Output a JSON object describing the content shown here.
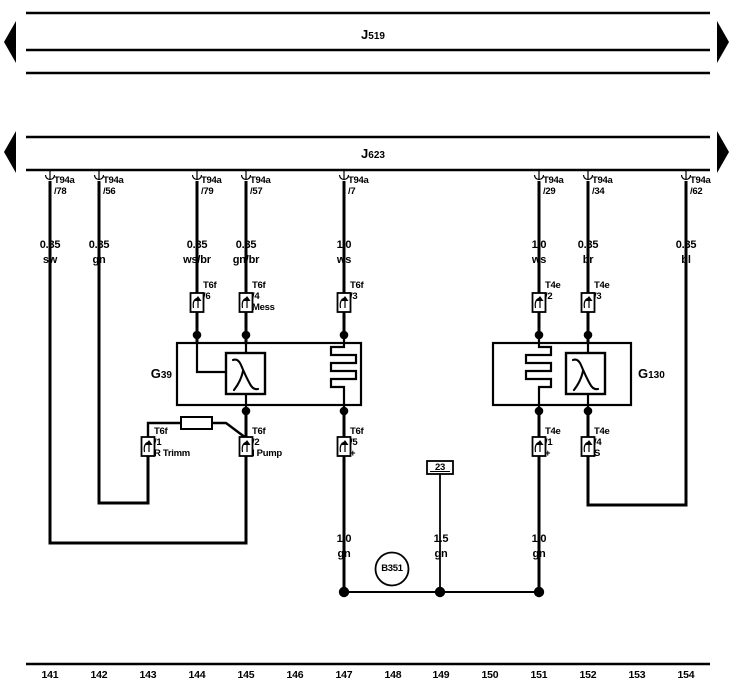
{
  "diagram_type": "wiring-diagram",
  "colors": {
    "line": "#000000",
    "background": "#ffffff"
  },
  "buses": {
    "j519": {
      "prefix": "J",
      "num": "519"
    },
    "j623": {
      "prefix": "J",
      "num": "623"
    }
  },
  "components": {
    "g39": {
      "prefix": "G",
      "num": "39"
    },
    "g130": {
      "prefix": "G",
      "num": "130"
    },
    "b351": {
      "label": "B351"
    },
    "ground_point": {
      "label": "23"
    }
  },
  "top_connectors": [
    {
      "name": "T94a",
      "pin": "/78"
    },
    {
      "name": "T94a",
      "pin": "/56"
    },
    {
      "name": "T94a",
      "pin": "/79"
    },
    {
      "name": "T94a",
      "pin": "/57"
    },
    {
      "name": "T94a",
      "pin": "/7"
    },
    {
      "name": "T94a",
      "pin": "/29"
    },
    {
      "name": "T94a",
      "pin": "/34"
    },
    {
      "name": "T94a",
      "pin": "/62"
    }
  ],
  "wire_labels": [
    {
      "gauge": "0.35",
      "color": "sw"
    },
    {
      "gauge": "0.35",
      "color": "gn"
    },
    {
      "gauge": "0.35",
      "color": "ws/br"
    },
    {
      "gauge": "0.35",
      "color": "gn/br"
    },
    {
      "gauge": "1.0",
      "color": "ws"
    },
    {
      "gauge": "1.0",
      "color": "ws"
    },
    {
      "gauge": "0.35",
      "color": "br"
    },
    {
      "gauge": "0.35",
      "color": "bl"
    }
  ],
  "mid_connectors": [
    {
      "name": "T6f",
      "pin": "/6",
      "sub": ""
    },
    {
      "name": "T6f",
      "pin": "/4",
      "sub": "Mess"
    },
    {
      "name": "T6f",
      "pin": "/3",
      "sub": ""
    },
    {
      "name": "T4e",
      "pin": "/2",
      "sub": ""
    },
    {
      "name": "T4e",
      "pin": "/3",
      "sub": ""
    }
  ],
  "low_connectors": [
    {
      "name": "T6f",
      "pin": "/1",
      "sub": "R Trimm"
    },
    {
      "name": "T6f",
      "pin": "/2",
      "sub": "I Pump"
    },
    {
      "name": "T6f",
      "pin": "/5",
      "sub": "+"
    },
    {
      "name": "T4e",
      "pin": "/1",
      "sub": "+"
    },
    {
      "name": "T4e",
      "pin": "/4",
      "sub": "S"
    }
  ],
  "bottom_wire_labels": [
    {
      "gauge": "1.0",
      "color": "gn"
    },
    {
      "gauge": "1.5",
      "color": "gn"
    },
    {
      "gauge": "1.0",
      "color": "gn"
    }
  ],
  "tracks": [
    "141",
    "142",
    "143",
    "144",
    "145",
    "146",
    "147",
    "148",
    "149",
    "150",
    "151",
    "152",
    "153",
    "154"
  ]
}
